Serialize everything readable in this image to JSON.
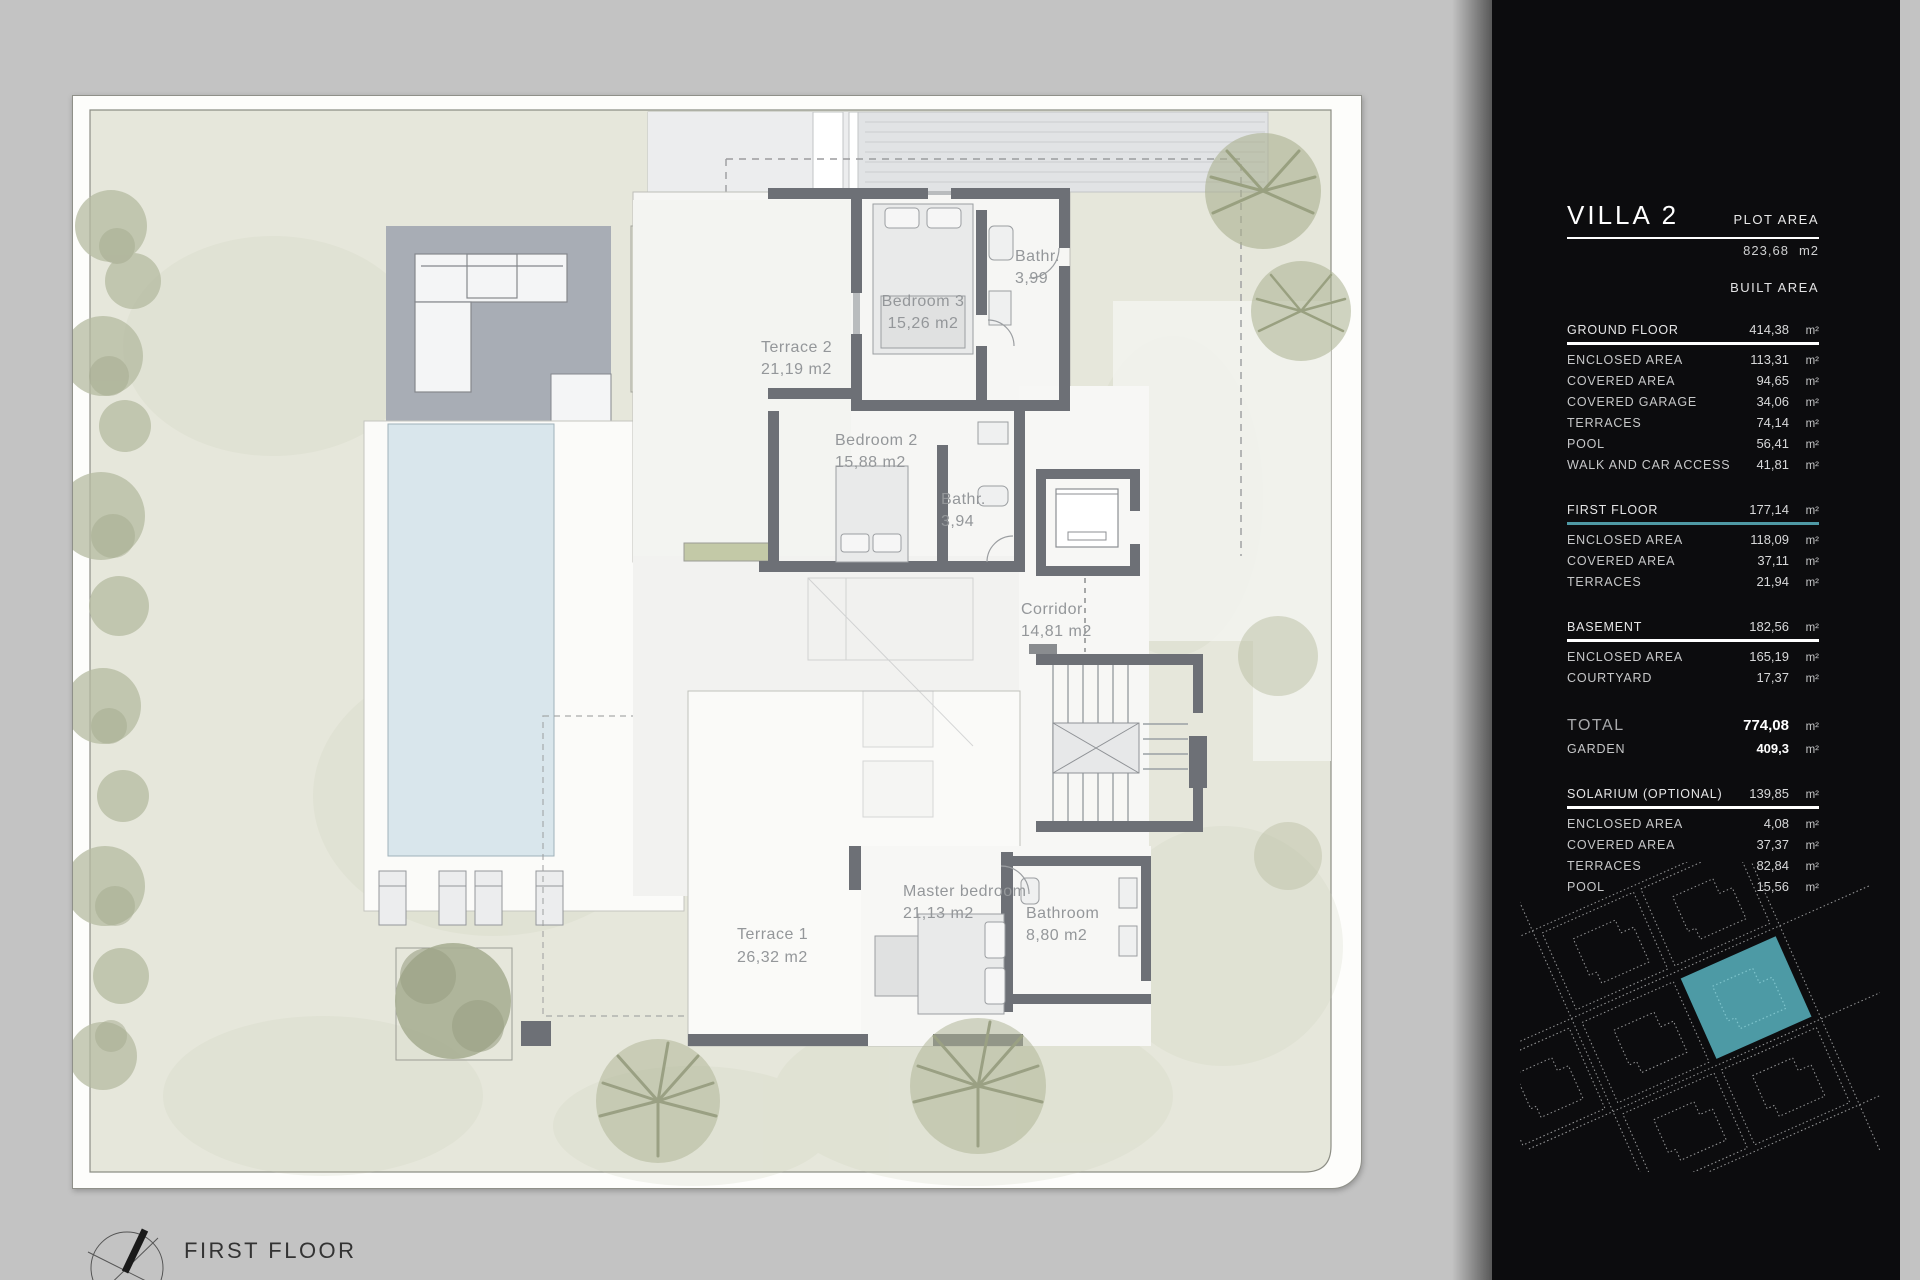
{
  "drawing": {
    "floor_label": "FIRST FLOOR"
  },
  "plan": {
    "rooms": [
      {
        "name": "Bedroom 3",
        "area": "15,26 m2"
      },
      {
        "name": "Bathr.",
        "area": "3,99"
      },
      {
        "name": "Terrace 2",
        "area": "21,19 m2"
      },
      {
        "name": "Bedroom 2",
        "area": "15,88 m2"
      },
      {
        "name": "Bathr.",
        "area": "3,94"
      },
      {
        "name": "Corridor",
        "area": "14,81 m2"
      },
      {
        "name": "Master bedroom",
        "area": "21,13 m2"
      },
      {
        "name": "Bathroom",
        "area": "8,80 m2"
      },
      {
        "name": "Terrace 1",
        "area": "26,32 m2"
      }
    ]
  },
  "panel": {
    "title": "VILLA 2",
    "accent_color": "#4f99a5",
    "plot": {
      "label": "PLOT AREA",
      "value": "823,68",
      "unit": "m2"
    },
    "built_label": "BUILT AREA",
    "groups": [
      {
        "header": {
          "label": "GROUND FLOOR",
          "value": "414,38",
          "unit": "m²"
        },
        "rows": [
          {
            "label": "ENCLOSED AREA",
            "value": "113,31",
            "unit": "m²"
          },
          {
            "label": "COVERED AREA",
            "value": "94,65",
            "unit": "m²"
          },
          {
            "label": "COVERED GARAGE",
            "value": "34,06",
            "unit": "m²"
          },
          {
            "label": "TERRACES",
            "value": "74,14",
            "unit": "m²"
          },
          {
            "label": "POOL",
            "value": "56,41",
            "unit": "m²"
          },
          {
            "label": "WALK AND CAR ACCESS",
            "value": "41,81",
            "unit": "m²"
          }
        ]
      },
      {
        "header": {
          "label": "FIRST FLOOR",
          "value": "177,14",
          "unit": "m²"
        },
        "rows": [
          {
            "label": "ENCLOSED AREA",
            "value": "118,09",
            "unit": "m²"
          },
          {
            "label": "COVERED AREA",
            "value": "37,11",
            "unit": "m²"
          },
          {
            "label": "TERRACES",
            "value": "21,94",
            "unit": "m²"
          }
        ]
      },
      {
        "header": {
          "label": "BASEMENT",
          "value": "182,56",
          "unit": "m²"
        },
        "rows": [
          {
            "label": "ENCLOSED AREA",
            "value": "165,19",
            "unit": "m²"
          },
          {
            "label": "COURTYARD",
            "value": "17,37",
            "unit": "m²"
          }
        ]
      }
    ],
    "totals": {
      "total": {
        "label": "TOTAL",
        "value": "774,08",
        "unit": "m²"
      },
      "garden": {
        "label": "GARDEN",
        "value": "409,3",
        "unit": "m²"
      }
    },
    "solarium": {
      "header": {
        "label": "SOLARIUM (OPTIONAL)",
        "value": "139,85",
        "unit": "m²"
      },
      "rows": [
        {
          "label": "ENCLOSED AREA",
          "value": "4,08",
          "unit": "m²"
        },
        {
          "label": "COVERED AREA",
          "value": "37,37",
          "unit": "m²"
        },
        {
          "label": "TERRACES",
          "value": "82,84",
          "unit": "m²"
        },
        {
          "label": "POOL",
          "value": "15,56",
          "unit": "m²"
        }
      ]
    }
  }
}
